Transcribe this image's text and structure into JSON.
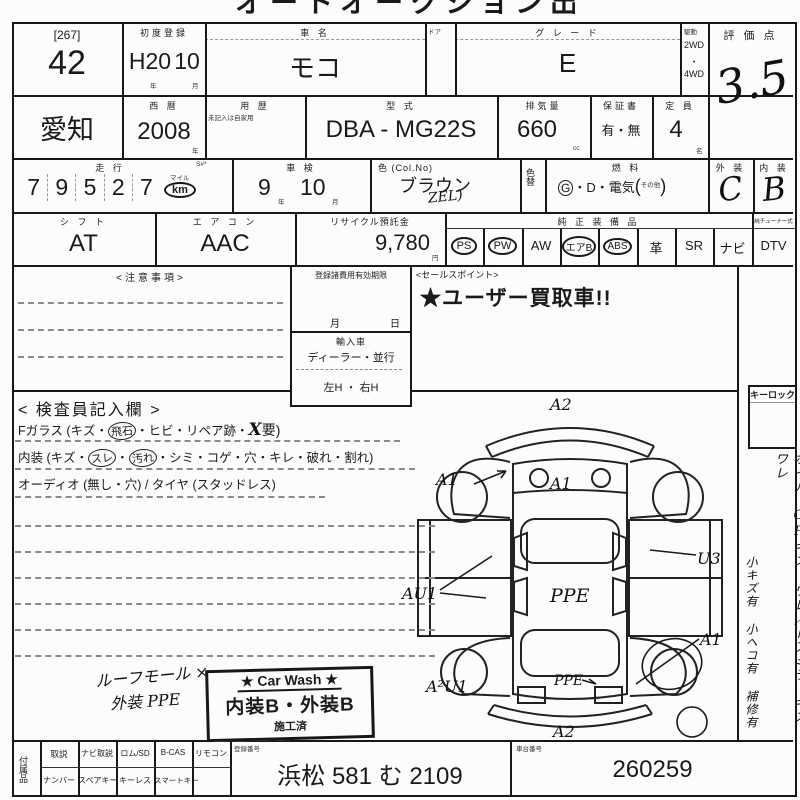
{
  "paper": {
    "clipped_title": "オートオークション出品票"
  },
  "row1": {
    "lot_bracket": "[267]",
    "lot_number": "42",
    "first_reg": {
      "label": "初度登録",
      "era": "H20",
      "month": "10",
      "year_suffix": "年",
      "month_suffix": "月"
    },
    "car_name": {
      "label": "車  名",
      "value": "モコ"
    },
    "door": {
      "label": "ドア"
    },
    "grade": {
      "label": "グ レ ー ド",
      "value": "E"
    },
    "drive": {
      "label": "駆動",
      "opt1": "2WD",
      "dot": "・",
      "opt2": "4WD"
    },
    "score": {
      "label": "評 価 点",
      "value": "3.5"
    }
  },
  "row2": {
    "prefecture": "愛知",
    "calendar": {
      "label": "西  暦",
      "value": "2008",
      "suffix": "年"
    },
    "usage": {
      "label": "用  歴",
      "note": "未記入は自家用"
    },
    "model": {
      "label": "型  式",
      "value": "DBA - MG22S"
    },
    "displacement": {
      "label": "排気量",
      "value": "660",
      "suffix": "cc"
    },
    "warranty": {
      "label": "保証書",
      "value": "有・無"
    },
    "capacity": {
      "label": "定  員",
      "value": "4",
      "suffix": "名"
    }
  },
  "row3": {
    "mileage": {
      "label": "走  行",
      "s_label": "S#*",
      "digits": [
        "7",
        "9",
        "5",
        "2",
        "7"
      ],
      "mile": "マイル",
      "km": "km"
    },
    "shaken": {
      "label": "車  検",
      "year": "9",
      "year_suffix": "年",
      "month": "10",
      "month_suffix": "月"
    },
    "color": {
      "label": "色 (Col.No)",
      "value": "ブラウン",
      "code": "ZEL)"
    },
    "color_change": {
      "label": "色替"
    },
    "fuel": {
      "label": "燃  料",
      "g": "G",
      "rest": "・D・電気",
      "paren_open": "(",
      "other": "その他",
      "paren_close": ")"
    },
    "exterior": {
      "label": "外 装",
      "value": "C"
    },
    "interior": {
      "label": "内 装",
      "value": "B"
    }
  },
  "row4": {
    "shift": {
      "label": "シ フ ト",
      "value": "AT"
    },
    "aircon": {
      "label": "エ ア コ ン",
      "value": "AAC"
    },
    "recycle": {
      "label": "リサイクル預託金",
      "value": "9,780",
      "suffix": "円"
    },
    "equipment": {
      "label": "純 正 装 備 品",
      "items": [
        {
          "label": "PS"
        },
        {
          "label": "PW"
        },
        {
          "label": "AW"
        },
        {
          "label": "エアB"
        },
        {
          "label": "ABS"
        },
        {
          "label": "革"
        },
        {
          "label": "SR"
        },
        {
          "label": "ナビ"
        }
      ],
      "dtv_header": "純チューナー式",
      "dtv": "DTV"
    }
  },
  "notes_box": {
    "label": "<注意事項>"
  },
  "reg_fee_box": {
    "label": "登録諸費用有効期限",
    "month": "月",
    "day": "日",
    "import_label": "輸入車",
    "dealer": "ディーラー・並行",
    "handle": "左H ・ 右H"
  },
  "sales_point": {
    "label": "<セールスポイント>",
    "text": "★ユーザー買取車!!"
  },
  "inspector": {
    "title": "< 検査員記入欄 >",
    "fglass": {
      "p1": "Fガラス (キズ・",
      "c1": "飛石",
      "p2": "・ヒビ・リペア跡・",
      "hand": "X",
      "p3": "要)"
    },
    "interior_line": {
      "p1": "内装 (キズ・",
      "c1": "スレ",
      "dot": "・",
      "c2": "汚れ",
      "p2": "・シミ・コゲ・穴・キレ・破れ・割れ)"
    },
    "audio_line": "オーディオ (無し・穴) / タイヤ (スタッドレス)",
    "hand_note1": "ルーフモール ×",
    "hand_note2": "外装 PPE"
  },
  "carwash": {
    "title": "★ Car Wash ★",
    "line2": "内装B・外装B",
    "line3": "施工済"
  },
  "diagram": {
    "marks": {
      "front": "A2",
      "left_front": "A1",
      "hood": "A1",
      "left_side": "AU1",
      "roof": "PPE",
      "right_rear_door": "U3",
      "right_rear": "A1",
      "rear_left": "A²U1",
      "rear_glass": "PPE",
      "rear": "A2"
    }
  },
  "right_column": {
    "keylock": "キーロック",
    "note1": "ホイル・CPキズ ワレ／ドアミラーキズ ワレ",
    "note2": "小キズ有 小ヘコ有 補修有"
  },
  "bottom": {
    "accessories_label": "付属品",
    "row1": [
      "取説",
      "ナビ取説",
      "ロム/SD",
      "B-CAS",
      "リモコン"
    ],
    "row2": [
      "ナンバー",
      "スペアキー",
      "キーレス",
      "スマートキー"
    ],
    "reg_no": {
      "label": "登録番号",
      "value": "浜松 581 む 2109"
    },
    "chassis": {
      "label": "車台番号",
      "value": "260259"
    }
  }
}
